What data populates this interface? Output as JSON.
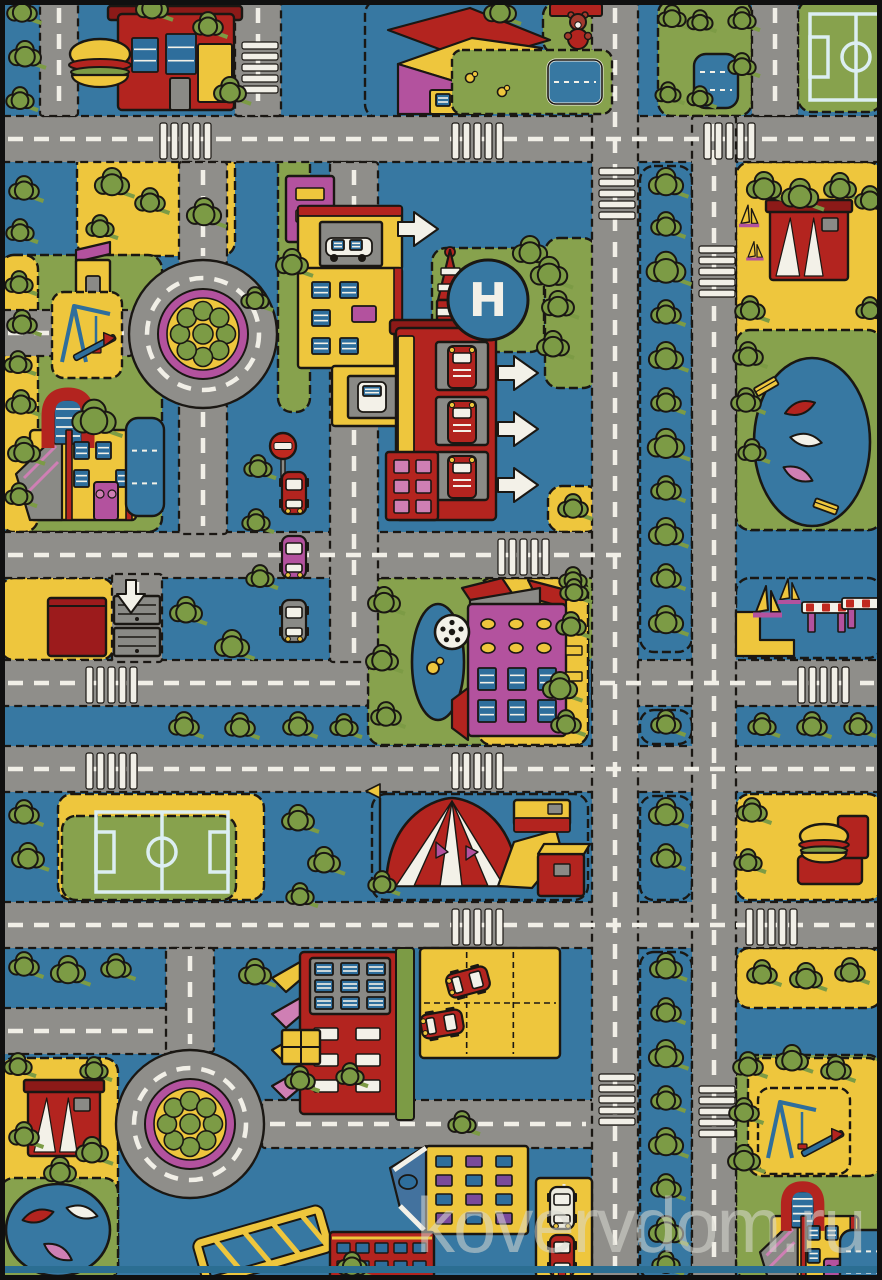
{
  "meta": {
    "watermark": "kovervdom.ru",
    "subject": "children-city-roads-play-rug-photo"
  },
  "helipad": {
    "label": "H"
  },
  "palette": {
    "bg": "#3778a2",
    "road": "#8f8e8a",
    "line": "#f1efe7",
    "ink": "#1a1713",
    "grass": "#87a24d",
    "tree": "#7c9b45",
    "tree2": "#96b157",
    "yellow": "#eec63d",
    "red": "#b3241f",
    "red2": "#8c1a18",
    "magenta": "#b3529e",
    "pink": "#cf7fb4",
    "white": "#f3f1e8",
    "winblue": "#2e6e9c",
    "fieldline": "#dceef2",
    "gray": "#8a8a86",
    "purple": "#7a4a9b",
    "roofblue": "#43729e",
    "frame": "#101010",
    "teal": "#2b6e92",
    "watermark_color": "rgba(216,216,210,0.55)"
  },
  "scene": {
    "w": 882,
    "h": 1280,
    "roads_h": [
      [
        0,
        116,
        882,
        46
      ],
      [
        0,
        532,
        636,
        46
      ],
      [
        0,
        660,
        368,
        46
      ],
      [
        592,
        660,
        290,
        46
      ],
      [
        0,
        746,
        882,
        46
      ],
      [
        0,
        902,
        882,
        46
      ],
      [
        0,
        1008,
        170,
        46
      ],
      [
        262,
        1100,
        332,
        48
      ],
      [
        0,
        310,
        132,
        46
      ]
    ],
    "roads_v": [
      [
        40,
        0,
        38,
        116
      ],
      [
        235,
        0,
        46,
        116
      ],
      [
        179,
        162,
        48,
        102
      ],
      [
        179,
        404,
        48,
        130
      ],
      [
        330,
        162,
        48,
        500
      ],
      [
        592,
        0,
        46,
        1280
      ],
      [
        692,
        116,
        44,
        1164
      ],
      [
        752,
        0,
        46,
        116
      ],
      [
        112,
        574,
        50,
        88
      ],
      [
        166,
        948,
        48,
        104
      ]
    ],
    "roundabouts": [
      [
        203,
        334
      ],
      [
        190,
        1124
      ]
    ],
    "crosswalks": [
      [
        160,
        118,
        "h"
      ],
      [
        452,
        118,
        "h"
      ],
      [
        704,
        118,
        "h"
      ],
      [
        498,
        534,
        "h"
      ],
      [
        86,
        662,
        "h"
      ],
      [
        798,
        662,
        "h"
      ],
      [
        86,
        748,
        "h"
      ],
      [
        452,
        748,
        "h"
      ],
      [
        452,
        904,
        "h"
      ],
      [
        746,
        904,
        "h"
      ],
      [
        594,
        168,
        "v"
      ],
      [
        594,
        1074,
        "v"
      ],
      [
        694,
        246,
        "v"
      ],
      [
        694,
        1086,
        "v"
      ],
      [
        237,
        42,
        "v"
      ]
    ],
    "blocks": [
      [
        365,
        0,
        247,
        118,
        "bg"
      ],
      [
        543,
        2,
        68,
        52,
        "grass"
      ],
      [
        658,
        0,
        94,
        116,
        "grass"
      ],
      [
        798,
        0,
        84,
        112,
        "grass"
      ],
      [
        77,
        150,
        158,
        106,
        "yellow"
      ],
      [
        278,
        150,
        32,
        262,
        "grass"
      ],
      [
        736,
        162,
        146,
        368,
        "yellow"
      ],
      [
        736,
        330,
        146,
        200,
        "grass"
      ],
      [
        0,
        255,
        162,
        277,
        "grass"
      ],
      [
        0,
        255,
        38,
        277,
        "yellow"
      ],
      [
        432,
        248,
        112,
        104,
        "grass"
      ],
      [
        545,
        238,
        52,
        150,
        "grass"
      ],
      [
        552,
        556,
        44,
        106,
        "grass"
      ],
      [
        548,
        486,
        52,
        46,
        "yellow"
      ],
      [
        0,
        578,
        114,
        82,
        "yellow"
      ],
      [
        368,
        578,
        220,
        167,
        "grass"
      ],
      [
        478,
        578,
        110,
        167,
        "yellow"
      ],
      [
        736,
        578,
        146,
        80,
        "bg"
      ],
      [
        58,
        794,
        206,
        106,
        "yellow"
      ],
      [
        62,
        816,
        174,
        84,
        "grass"
      ],
      [
        372,
        794,
        216,
        106,
        "bg"
      ],
      [
        736,
        794,
        146,
        106,
        "yellow"
      ],
      [
        736,
        948,
        146,
        60,
        "yellow"
      ],
      [
        0,
        1058,
        118,
        222,
        "yellow"
      ],
      [
        0,
        1178,
        118,
        102,
        "grass"
      ],
      [
        736,
        1055,
        146,
        225,
        "grass"
      ],
      [
        748,
        1058,
        134,
        118,
        "yellow"
      ],
      [
        640,
        166,
        52,
        486,
        "bg"
      ],
      [
        640,
        710,
        52,
        34,
        "bg"
      ],
      [
        640,
        796,
        52,
        104,
        "bg"
      ],
      [
        640,
        952,
        52,
        328,
        "bg"
      ]
    ],
    "trees": [
      [
        22,
        12,
        13
      ],
      [
        25,
        56,
        14
      ],
      [
        20,
        100,
        12
      ],
      [
        24,
        190,
        13
      ],
      [
        20,
        232,
        12
      ],
      [
        19,
        284,
        12
      ],
      [
        22,
        324,
        13
      ],
      [
        18,
        364,
        12
      ],
      [
        21,
        404,
        13
      ],
      [
        24,
        452,
        14
      ],
      [
        19,
        496,
        12
      ],
      [
        152,
        8,
        14
      ],
      [
        208,
        26,
        13
      ],
      [
        230,
        92,
        14
      ],
      [
        112,
        184,
        15
      ],
      [
        150,
        202,
        13
      ],
      [
        204,
        214,
        15
      ],
      [
        100,
        228,
        12
      ],
      [
        94,
        420,
        19
      ],
      [
        292,
        264,
        14
      ],
      [
        255,
        300,
        12
      ],
      [
        500,
        12,
        14
      ],
      [
        530,
        252,
        15
      ],
      [
        549,
        274,
        16
      ],
      [
        558,
        306,
        14
      ],
      [
        553,
        346,
        14
      ],
      [
        573,
        508,
        13
      ],
      [
        573,
        580,
        12
      ],
      [
        571,
        626,
        13
      ],
      [
        258,
        468,
        12
      ],
      [
        256,
        522,
        12
      ],
      [
        260,
        578,
        12
      ],
      [
        186,
        612,
        14
      ],
      [
        232,
        646,
        15
      ],
      [
        184,
        726,
        13
      ],
      [
        240,
        727,
        13
      ],
      [
        298,
        726,
        13
      ],
      [
        344,
        727,
        12
      ],
      [
        762,
        726,
        12
      ],
      [
        812,
        726,
        13
      ],
      [
        858,
        726,
        12
      ],
      [
        764,
        188,
        15
      ],
      [
        800,
        196,
        16
      ],
      [
        840,
        188,
        14
      ],
      [
        870,
        200,
        13
      ],
      [
        750,
        310,
        13
      ],
      [
        748,
        356,
        13
      ],
      [
        746,
        402,
        13
      ],
      [
        752,
        452,
        12
      ],
      [
        870,
        310,
        12
      ],
      [
        384,
        602,
        14
      ],
      [
        382,
        660,
        14
      ],
      [
        386,
        716,
        13
      ],
      [
        574,
        592,
        12
      ],
      [
        560,
        688,
        15
      ],
      [
        566,
        724,
        13
      ],
      [
        24,
        814,
        13
      ],
      [
        28,
        858,
        14
      ],
      [
        298,
        820,
        14
      ],
      [
        324,
        862,
        14
      ],
      [
        300,
        896,
        12
      ],
      [
        382,
        884,
        12
      ],
      [
        752,
        812,
        13
      ],
      [
        748,
        862,
        12
      ],
      [
        24,
        966,
        13
      ],
      [
        68,
        972,
        15
      ],
      [
        116,
        968,
        13
      ],
      [
        255,
        974,
        14
      ],
      [
        762,
        974,
        13
      ],
      [
        806,
        978,
        14
      ],
      [
        850,
        972,
        13
      ],
      [
        18,
        1066,
        12
      ],
      [
        94,
        1070,
        12
      ],
      [
        24,
        1136,
        13
      ],
      [
        92,
        1152,
        14
      ],
      [
        60,
        1172,
        14
      ],
      [
        748,
        1066,
        13
      ],
      [
        792,
        1060,
        14
      ],
      [
        836,
        1070,
        13
      ],
      [
        744,
        1112,
        13
      ],
      [
        744,
        1160,
        14
      ],
      [
        352,
        1266,
        13
      ],
      [
        462,
        1124,
        12
      ],
      [
        300,
        1080,
        13
      ],
      [
        350,
        1076,
        12
      ],
      [
        672,
        18,
        12
      ],
      [
        700,
        22,
        11
      ],
      [
        668,
        94,
        11
      ],
      [
        700,
        98,
        11
      ],
      [
        742,
        20,
        12
      ],
      [
        742,
        66,
        12
      ],
      [
        666,
        184,
        15
      ],
      [
        666,
        226,
        13
      ],
      [
        666,
        270,
        17
      ],
      [
        666,
        314,
        13
      ],
      [
        666,
        358,
        15
      ],
      [
        666,
        402,
        13
      ],
      [
        666,
        446,
        16
      ],
      [
        666,
        490,
        13
      ],
      [
        666,
        534,
        15
      ],
      [
        666,
        578,
        13
      ],
      [
        666,
        622,
        15
      ],
      [
        666,
        724,
        13
      ],
      [
        666,
        814,
        15
      ],
      [
        666,
        858,
        13
      ],
      [
        666,
        968,
        14
      ],
      [
        666,
        1012,
        13
      ],
      [
        666,
        1056,
        15
      ],
      [
        666,
        1100,
        13
      ],
      [
        666,
        1144,
        15
      ],
      [
        666,
        1188,
        13
      ],
      [
        666,
        1232,
        15
      ],
      [
        666,
        1264,
        12
      ]
    ],
    "landmarks": [
      {
        "t": "burger_restaurant",
        "x": 118,
        "y": 14
      },
      {
        "t": "small_shop",
        "x": 76,
        "y": 250
      },
      {
        "t": "house",
        "x": 388,
        "y": 6
      },
      {
        "t": "garden",
        "x": 452,
        "y": 50,
        "w": 160,
        "h": 64
      },
      {
        "t": "teddy_bear",
        "x": 578,
        "y": 22
      },
      {
        "t": "pool",
        "x": 548,
        "y": 60,
        "w": 54,
        "h": 44
      },
      {
        "t": "pond",
        "x": 694,
        "y": 54,
        "w": 44,
        "h": 54
      },
      {
        "t": "soccer_field",
        "x": 810,
        "y": 14,
        "w": 92,
        "h": 86
      },
      {
        "t": "soccer_field",
        "x": 96,
        "y": 812,
        "w": 132,
        "h": 80
      },
      {
        "t": "playground",
        "x": 52,
        "y": 292,
        "w": 70,
        "h": 86
      },
      {
        "t": "playground",
        "x": 758,
        "y": 1088,
        "w": 92,
        "h": 86
      },
      {
        "t": "school",
        "x": 16,
        "y": 386,
        "s": 1
      },
      {
        "t": "school",
        "x": 760,
        "y": 1180,
        "s": 0.82
      },
      {
        "t": "pond",
        "x": 126,
        "y": 418,
        "w": 38,
        "h": 98
      },
      {
        "t": "shops",
        "x": 286,
        "y": 176
      },
      {
        "t": "rocket_tower",
        "x": 438,
        "y": 248
      },
      {
        "t": "no_entry_sign",
        "x": 283,
        "y": 446
      },
      {
        "t": "fire_station",
        "x": 396,
        "y": 328
      },
      {
        "t": "helipad",
        "x": 488,
        "y": 300
      },
      {
        "t": "garage_doors",
        "x": 114,
        "y": 596
      },
      {
        "t": "shed",
        "x": 48,
        "y": 598
      },
      {
        "t": "hotel",
        "x": 452,
        "y": 580
      },
      {
        "t": "marina",
        "x": 736,
        "y": 578
      },
      {
        "t": "sailboat",
        "x": 766,
        "y": 610,
        "s": 1
      },
      {
        "t": "sailboat",
        "x": 788,
        "y": 598,
        "s": 0.8
      },
      {
        "t": "sailboat",
        "x": 748,
        "y": 222,
        "s": 0.7
      },
      {
        "t": "sailboat",
        "x": 754,
        "y": 256,
        "s": 0.6
      },
      {
        "t": "barrier",
        "x": 806,
        "y": 602
      },
      {
        "t": "barrier",
        "x": 846,
        "y": 598
      },
      {
        "t": "tent",
        "x": 386,
        "y": 798
      },
      {
        "t": "stalls",
        "x": 514,
        "y": 800
      },
      {
        "t": "kiosk",
        "x": 770,
        "y": 206,
        "w": 78,
        "h": 74
      },
      {
        "t": "kiosk",
        "x": 28,
        "y": 1086,
        "w": 72,
        "h": 70
      },
      {
        "t": "lake",
        "x": 812,
        "y": 442,
        "rx": 58,
        "ry": 84,
        "boats": [
          [
            800,
            408,
            -20,
            "red"
          ],
          [
            806,
            440,
            10,
            "white"
          ],
          [
            798,
            474,
            25,
            "pink"
          ]
        ]
      },
      {
        "t": "lake",
        "x": 58,
        "y": 1230,
        "rx": 52,
        "ry": 46,
        "boats": [
          [
            38,
            1216,
            -15,
            "red"
          ],
          [
            82,
            1212,
            15,
            "white"
          ],
          [
            58,
            1252,
            30,
            "pink"
          ]
        ]
      },
      {
        "t": "bench",
        "x": 766,
        "y": 386,
        "r": -30
      },
      {
        "t": "bench",
        "x": 826,
        "y": 506,
        "r": 20
      },
      {
        "t": "burger_stand",
        "x": 798,
        "y": 856
      },
      {
        "t": "apartment_building",
        "x": 300,
        "y": 952
      },
      {
        "t": "parking",
        "x": 420,
        "y": 948,
        "w": 140,
        "h": 110,
        "cars": [
          [
            468,
            982,
            75,
            "red"
          ],
          [
            442,
            1024,
            80,
            "red"
          ]
        ]
      },
      {
        "t": "parking",
        "x": 536,
        "y": 1178,
        "w": 56,
        "h": 100,
        "cars": [
          [
            562,
            1208,
            0,
            "white"
          ],
          [
            562,
            1256,
            0,
            "red"
          ]
        ]
      },
      {
        "t": "bridge",
        "x": 200,
        "y": 1214
      },
      {
        "t": "yellow_house",
        "x": 392,
        "y": 1146
      },
      {
        "t": "brick_building",
        "x": 330,
        "y": 1232
      },
      {
        "t": "pond",
        "x": 840,
        "y": 1230,
        "w": 56,
        "h": 64
      },
      {
        "t": "parked_car",
        "x": 282,
        "y": 472,
        "c": "red"
      },
      {
        "t": "parked_car",
        "x": 282,
        "y": 536,
        "c": "magenta"
      },
      {
        "t": "parked_car",
        "x": 282,
        "y": 600,
        "c": "gray"
      }
    ],
    "arrows": [
      {
        "x": 498,
        "y": 356,
        "d": "r"
      },
      {
        "x": 498,
        "y": 412,
        "d": "r"
      },
      {
        "x": 498,
        "y": 468,
        "d": "r"
      },
      {
        "x": 398,
        "y": 212,
        "d": "r"
      },
      {
        "x": 131,
        "y": 580,
        "d": "d"
      }
    ]
  }
}
